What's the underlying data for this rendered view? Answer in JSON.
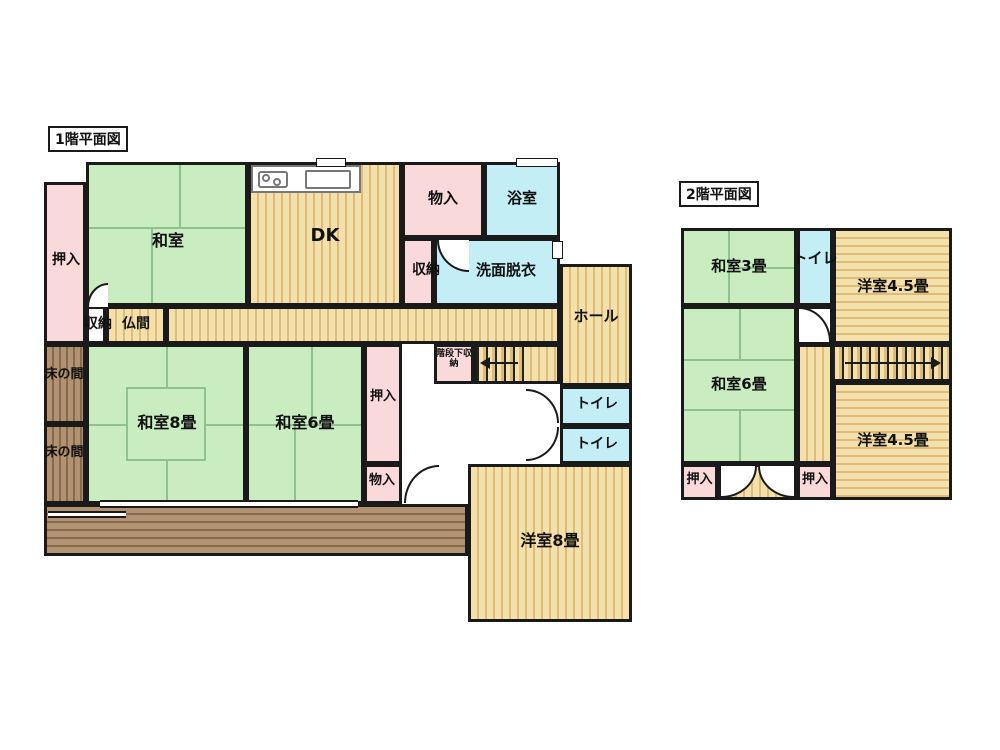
{
  "floor1": {
    "title": "1階平面図",
    "labels": {
      "oshiire_left": "押入",
      "washitsu": "和室",
      "dk": "DK",
      "monoire_top": "物入",
      "yokushitsu": "浴室",
      "shuno_top": "収納",
      "senmen": "洗面脱衣",
      "shuno_butsuma": "収納",
      "butsuma": "仏間",
      "hall": "ホール",
      "tokonoma_a": "床の間",
      "tokonoma_b": "床の間",
      "washitsu8": "和室8畳",
      "washitsu6": "和室6畳",
      "oshiire_mid": "押入",
      "kaidanshita": "階段下収納",
      "toilet_a": "トイレ",
      "toilet_b": "トイレ",
      "monoire_mid": "物入",
      "yoshitsu8": "洋室8畳"
    }
  },
  "floor2": {
    "title": "2階平面図",
    "labels": {
      "washitsu3": "和室3畳",
      "toilet": "トイレ",
      "yoshitsu45_top": "洋室4.5畳",
      "washitsu6": "和室6畳",
      "yoshitsu45_bottom": "洋室4.5畳",
      "oshiire_left": "押入",
      "oshiire_right": "押入"
    }
  },
  "colors": {
    "wall": "#1a1a1a",
    "tatami": "#c9ecc1",
    "closet": "#f9d9da",
    "water": "#c4eef6",
    "wood1": "#f3e0ab",
    "wood2": "#ddbb7a",
    "porch1": "#b19272",
    "porch2": "#876a4e"
  }
}
